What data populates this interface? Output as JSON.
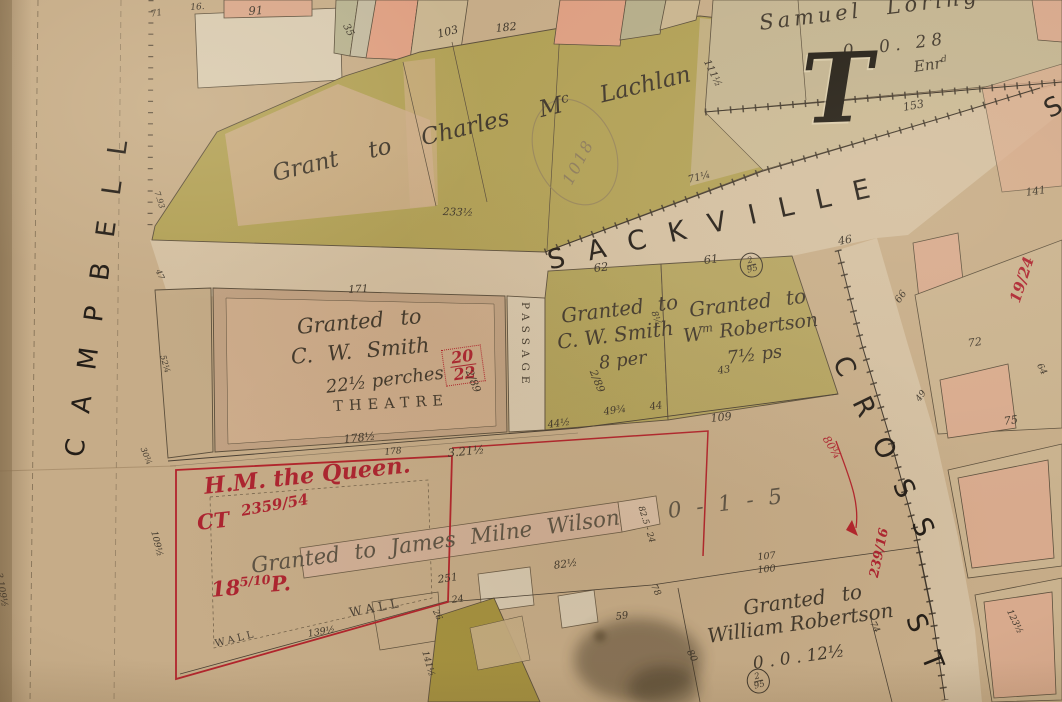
{
  "palette": {
    "paper": "#c6ac88",
    "street_surface": "#d3bfa1",
    "olive_lot": "#b1a056",
    "pink_lot": "#d8aa8d",
    "tan_lot": "#c9b28e",
    "ink": "#3e362b",
    "red_ink": "#ad2430",
    "street_lettering": "#241e18"
  },
  "streets": {
    "campbell": "CAMPBELL",
    "sackville": "SACKVILLE",
    "sackville_cont": "S",
    "cross": "CROSS",
    "cross_st": "ST"
  },
  "parcels": {
    "mclachlan": {
      "text": "Grant to Charles M",
      "sup": "c",
      "rest": " Lachlan"
    },
    "loring": {
      "name": "Samuel Loring",
      "area": "0. 0. 28",
      "enr_base": "Enr",
      "enr_sup": "d",
      "block_letter": "T"
    },
    "smith_theatre": {
      "granted": "Granted to",
      "name": "C. W. Smith",
      "area": "22½ perches",
      "building": "THEATRE"
    },
    "smith_east": {
      "granted": "Granted to",
      "name": "C. W. Smith",
      "area": "8 per"
    },
    "robertson_north": {
      "granted": "Granted to",
      "name_base": "W",
      "name_sup": "m",
      "name_rest": " Robertson",
      "area": "7½ ps"
    },
    "wilson": {
      "text": "Granted to James Milne Wilson",
      "area": "0 - 1 - 5"
    },
    "robertson_south": {
      "granted": "Granted to",
      "name": "William Robertson",
      "area": "0 . 0 . 12½"
    },
    "queen": {
      "owner": "H.M. the Queen.",
      "ct": "CT",
      "ct_frac": "2359/54",
      "area_base": "18",
      "area_frac": "5/10",
      "area_unit": "P."
    },
    "passage": "PASSAGE",
    "wall_a": "WALL",
    "wall_b": "WALL"
  },
  "annotations": {
    "red_lot_num": {
      "num": "20",
      "den": "22"
    },
    "plan_2_89": "2/89",
    "circle_2_95": {
      "num": "2",
      "den": "95"
    },
    "red_19_24": "19/24",
    "red_239_16": "239/16",
    "red_80": "80¾",
    "stamp": "1018"
  },
  "measurements": [
    "71",
    "91",
    "35",
    "103",
    "182",
    "111½",
    "153",
    "233½",
    "71¼",
    "141",
    "46",
    "62",
    "61",
    "66",
    "72",
    "64",
    "49",
    "75",
    "171",
    "178½",
    "178",
    "3.21½",
    "44½",
    "49¾",
    "44",
    "109",
    "43",
    "109½",
    "251",
    "24",
    "26",
    "139½",
    "82½",
    "82.5 - 24",
    "107",
    "100",
    "80",
    "78",
    "74",
    "59",
    "141½",
    "123½",
    "7.93",
    "47",
    "52¼",
    "30¾",
    "3.109½",
    "8¼",
    "16."
  ]
}
